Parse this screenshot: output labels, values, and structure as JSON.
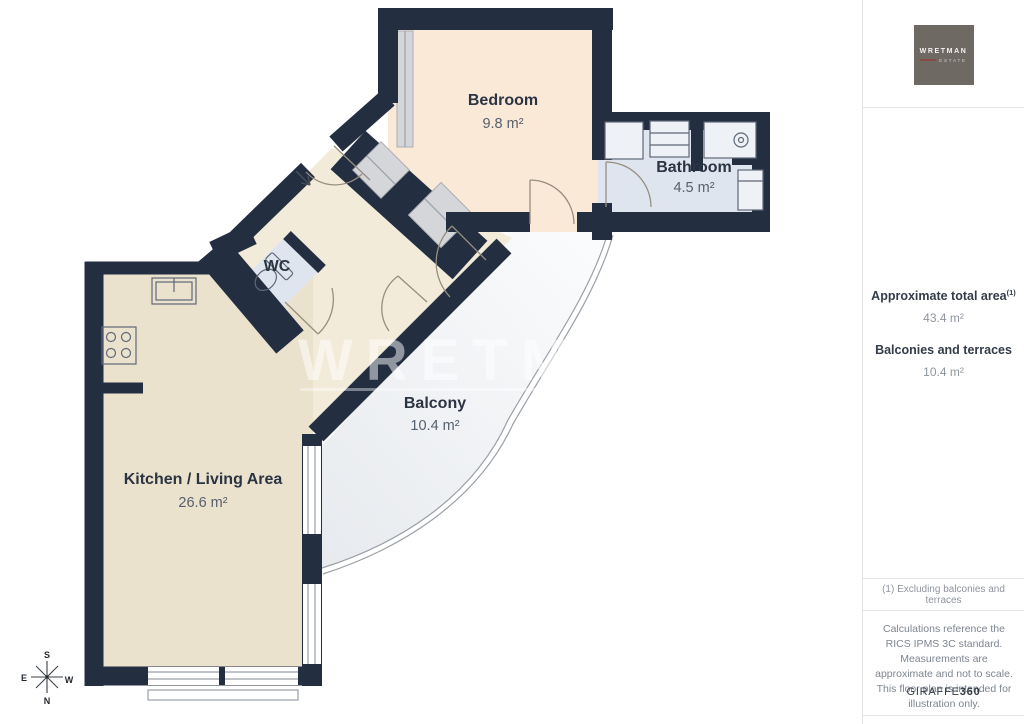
{
  "colors": {
    "wall": "#232e41",
    "bedroom": "#fbe9d8",
    "bath": "#dfe5ee",
    "hall": "#f3ebd9",
    "kitchen": "#ebe2cd",
    "closet": "#d5d6da",
    "balcony_light": "#fafbfc",
    "balcony_dark": "#e7eaee",
    "label": "#2b3442",
    "area_text": "#555f6d",
    "line": "#9aa0a8",
    "door": "#968e7f",
    "fixture": "#5f6878",
    "logo_bg": "#6f6963",
    "logo_accent": "#8a4a42",
    "divider": "#e4e5e7",
    "sidebar_heading": "#333c49",
    "sidebar_text": "#8e949d",
    "disclaimer_text": "#7d8590",
    "brand_text": "#333b46"
  },
  "plan": {
    "rooms": [
      {
        "name": "Bedroom",
        "area": "9.8 m²"
      },
      {
        "name": "Bathroom",
        "area": "4.5 m²"
      },
      {
        "name": "WC"
      },
      {
        "name": "Kitchen / Living Area",
        "area": "26.6 m²"
      },
      {
        "name": "Balcony",
        "area": "10.4 m²"
      }
    ],
    "compass": {
      "north": "N",
      "south": "S",
      "east": "E",
      "west": "W"
    },
    "watermark": "WRETMAN"
  },
  "sidebar": {
    "logo": {
      "line1": "WRETMAN",
      "line2": "ESTATE"
    },
    "total_area_label": "Approximate total area",
    "total_area_superscript": "(1)",
    "total_area_value": "43.4 m²",
    "balconies_label": "Balconies and terraces",
    "balconies_value": "10.4 m²",
    "footnote": "(1) Excluding balconies and terraces",
    "disclaimer": "Calculations reference the RICS IPMS 3C standard. Measurements are approximate and not to scale. This floor plan is intended for illustration only.",
    "brand": {
      "name": "GIRAFFE",
      "suffix": "360"
    }
  }
}
